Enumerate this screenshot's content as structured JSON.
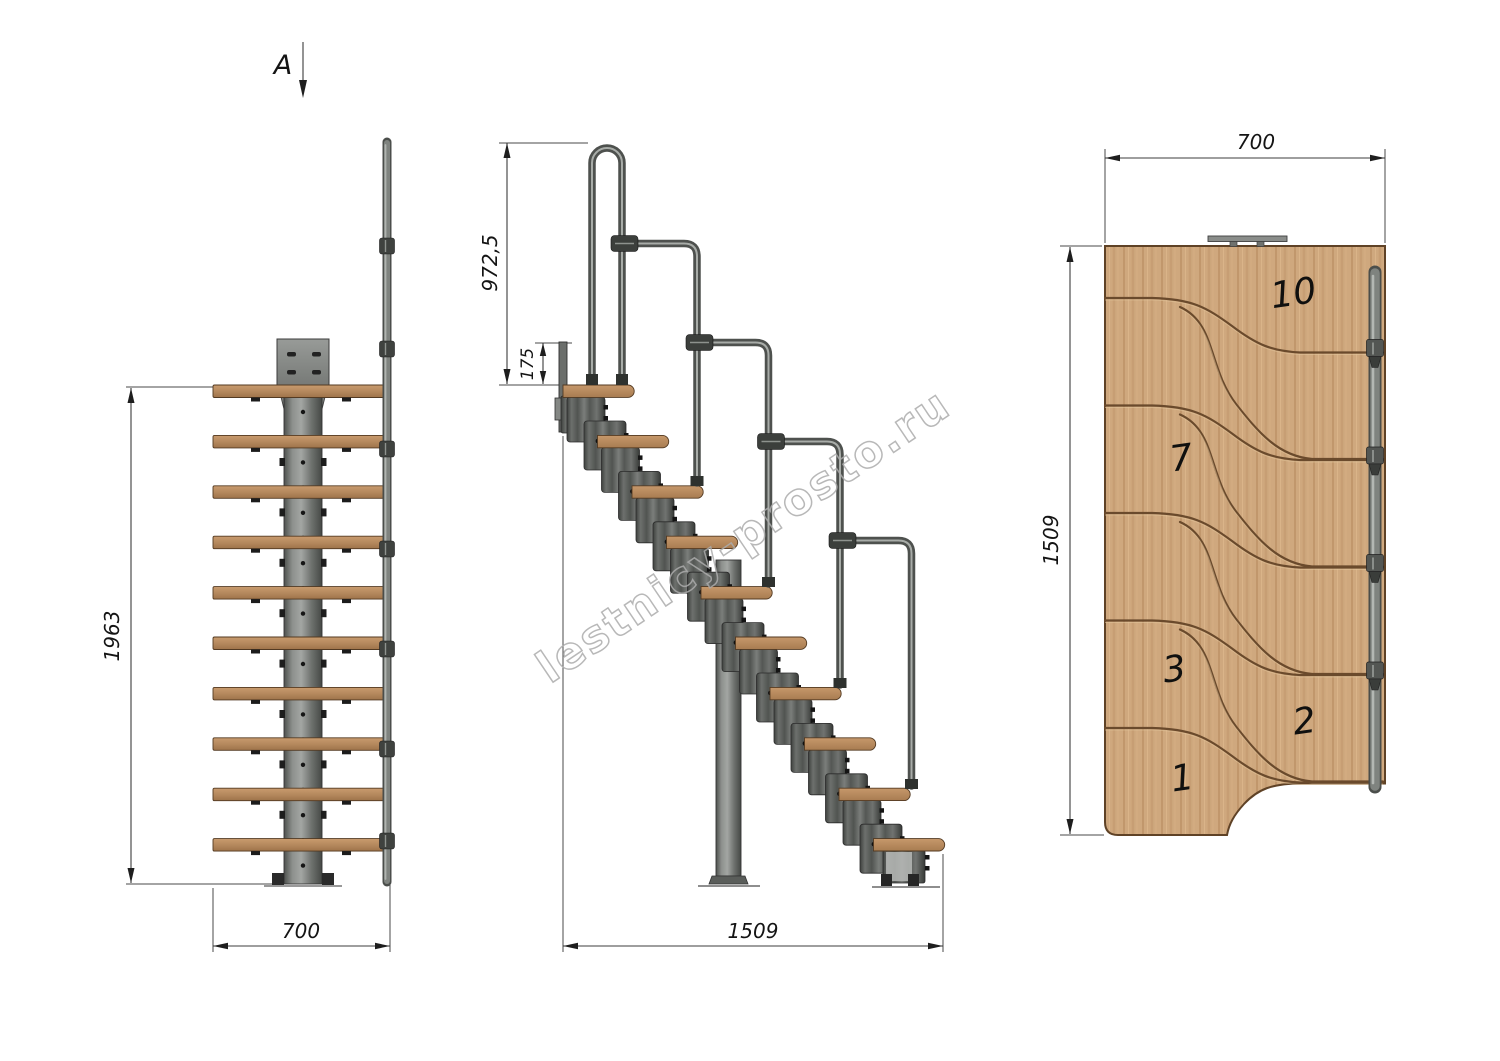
{
  "section_label": "A",
  "watermark": {
    "text": "lestnicy-prosto.ru",
    "color": "#acacac"
  },
  "front_view": {
    "height_dim": "1963",
    "width_dim": "700"
  },
  "side_view": {
    "handrail_height_dim": "972,5",
    "top_riser_dim": "175",
    "run_length_dim": "1509"
  },
  "plan_view": {
    "width_dim": "700",
    "depth_dim": "1509",
    "step_labels": [
      "10",
      "7",
      "3",
      "2",
      "1"
    ]
  },
  "colors": {
    "wood": "#cfa87e",
    "wood_groove": "#6a4a2c",
    "steel_mid": "#7f837f",
    "steel_dark": "#4b4e4b",
    "line": "#3c3c3c",
    "background": "#ffffff"
  }
}
